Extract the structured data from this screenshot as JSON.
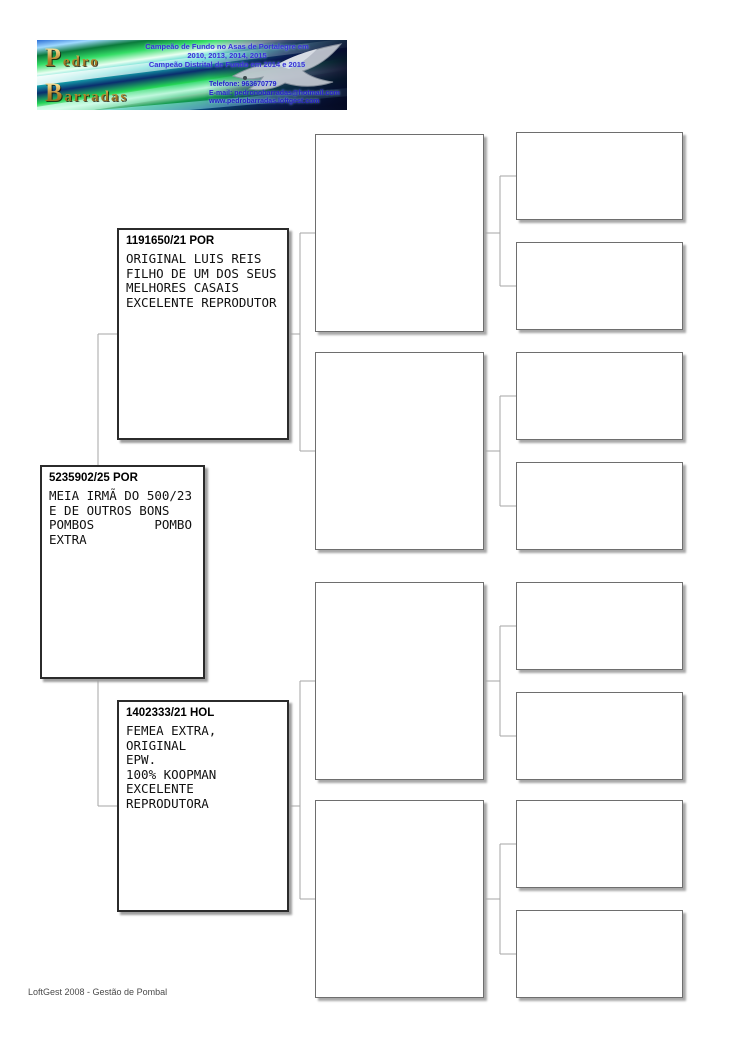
{
  "header": {
    "loft_name_line1": "Pedro",
    "loft_name_line2": "Barradas",
    "achievements": {
      "line1": "Campeão de Fundo no Asas de Portalegre em",
      "line2": "2010, 2013, 2014, 2015",
      "line3": "Campeão Distrital de Fundo em 2014 e 2015"
    },
    "contact": {
      "phone": "Telefone: 963670779",
      "email": "E-mail: pedronobarradas@hotmail.com",
      "website": "www.pedrobarradas.loftgest.com"
    },
    "logo_icon": "pigeon-icon"
  },
  "pedigree": {
    "subject": {
      "ring": "5235902/25 POR",
      "notes": "MEIA IRMÃ DO 500/23\nE DE OUTROS BONS\nPOMBOS        POMBO\nEXTRA"
    },
    "sire": {
      "ring": "1191650/21 POR",
      "notes": "ORIGINAL LUIS REIS\nFILHO DE UM DOS SEUS\nMELHORES CASAIS\nEXCELENTE REPRODUTOR"
    },
    "dam": {
      "ring": "1402333/21 HOL",
      "notes": "FEMEA EXTRA, ORIGINAL\nEPW.\n100% KOOPMAN\nEXCELENTE REPRODUTORA"
    },
    "generation3_boxes": [
      "",
      "",
      "",
      ""
    ],
    "generation4_boxes": [
      "",
      "",
      "",
      "",
      "",
      "",
      "",
      ""
    ]
  },
  "footer": {
    "text": "LoftGest 2008 - Gestão de Pombal"
  },
  "colors": {
    "connector_line": "#a5a5a5",
    "box_border_dark": "#2b2b2b",
    "box_border_light": "#6e6e6e",
    "box_shadow": "#9e9e9e",
    "logo_gold": "#caa23e",
    "logo_text_blue": "#3c2fd6",
    "page_background": "#ffffff"
  }
}
